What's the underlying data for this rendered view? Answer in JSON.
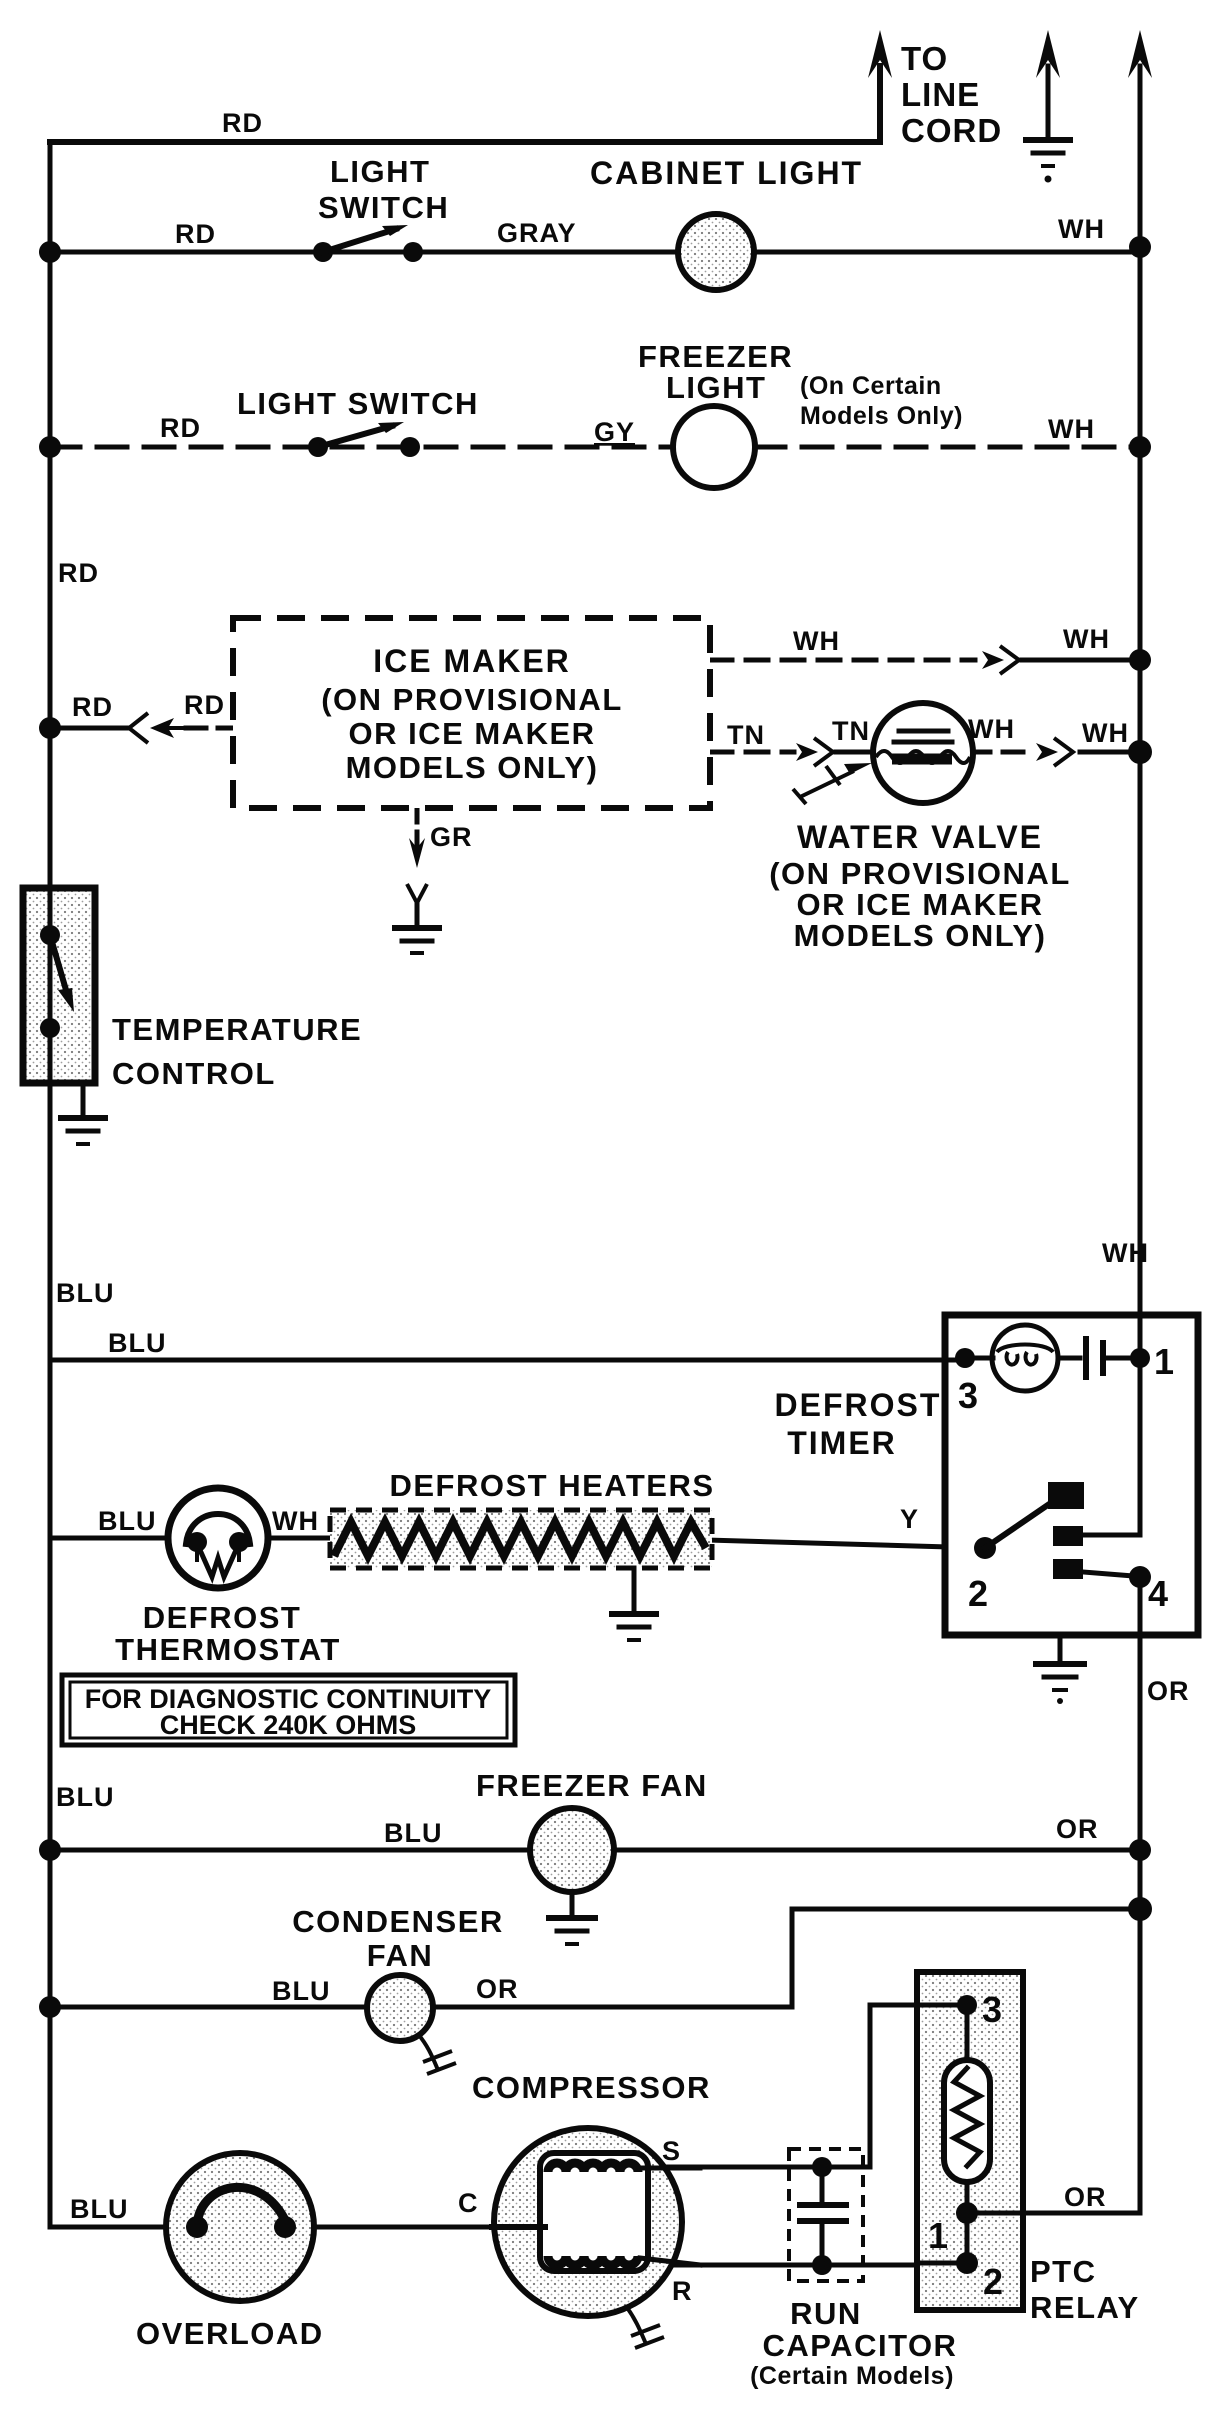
{
  "colors": {
    "ink": "#0a0a0a",
    "paper": "#ffffff"
  },
  "wire_labels": {
    "rd": "RD",
    "wh": "WH",
    "blu": "BLU",
    "or": "OR",
    "tn": "TN",
    "gy": "GY",
    "gray": "GRAY",
    "y": "Y",
    "gr": "GR",
    "c": "C",
    "s": "S",
    "r": "R"
  },
  "line_cord": {
    "lines": [
      "TO",
      "LINE",
      "CORD"
    ]
  },
  "components": {
    "light_switch_cabinet": {
      "lines": [
        "LIGHT",
        "SWITCH"
      ]
    },
    "cabinet_light": {
      "label": "CABINET LIGHT"
    },
    "light_switch_freezer": {
      "label": "LIGHT SWITCH"
    },
    "freezer_light": {
      "name1": "FREEZER",
      "name2": "LIGHT",
      "note1": "(On Certain",
      "note2": "Models Only)"
    },
    "ice_maker": {
      "lines": [
        "ICE MAKER",
        "(ON PROVISIONAL",
        "OR ICE MAKER",
        "MODELS ONLY)"
      ]
    },
    "water_valve": {
      "lines": [
        "WATER VALVE",
        "(ON PROVISIONAL",
        "OR ICE MAKER",
        "MODELS ONLY)"
      ]
    },
    "temperature_control": {
      "lines": [
        "TEMPERATURE",
        "CONTROL"
      ]
    },
    "defrost_timer": {
      "lines": [
        "DEFROST",
        "TIMER"
      ],
      "terminals": {
        "t1": "1",
        "t2": "2",
        "t3": "3",
        "t4": "4"
      }
    },
    "defrost_heaters": {
      "label": "DEFROST HEATERS"
    },
    "defrost_thermostat": {
      "lines": [
        "DEFROST",
        "THERMOSTAT"
      ]
    },
    "diagnostic_note": {
      "lines": [
        "FOR DIAGNOSTIC CONTINUITY",
        "CHECK 240K OHMS"
      ]
    },
    "freezer_fan": {
      "label": "FREEZER FAN"
    },
    "condenser_fan": {
      "lines": [
        "CONDENSER",
        "FAN"
      ]
    },
    "compressor": {
      "label": "COMPRESSOR"
    },
    "overload": {
      "label": "OVERLOAD"
    },
    "run_capacitor": {
      "lines": [
        "RUN",
        "CAPACITOR",
        "(Certain Models)"
      ]
    },
    "ptc_relay": {
      "lines": [
        "PTC",
        "RELAY"
      ],
      "terminals": {
        "t1": "1",
        "t2": "2",
        "t3": "3"
      }
    }
  }
}
